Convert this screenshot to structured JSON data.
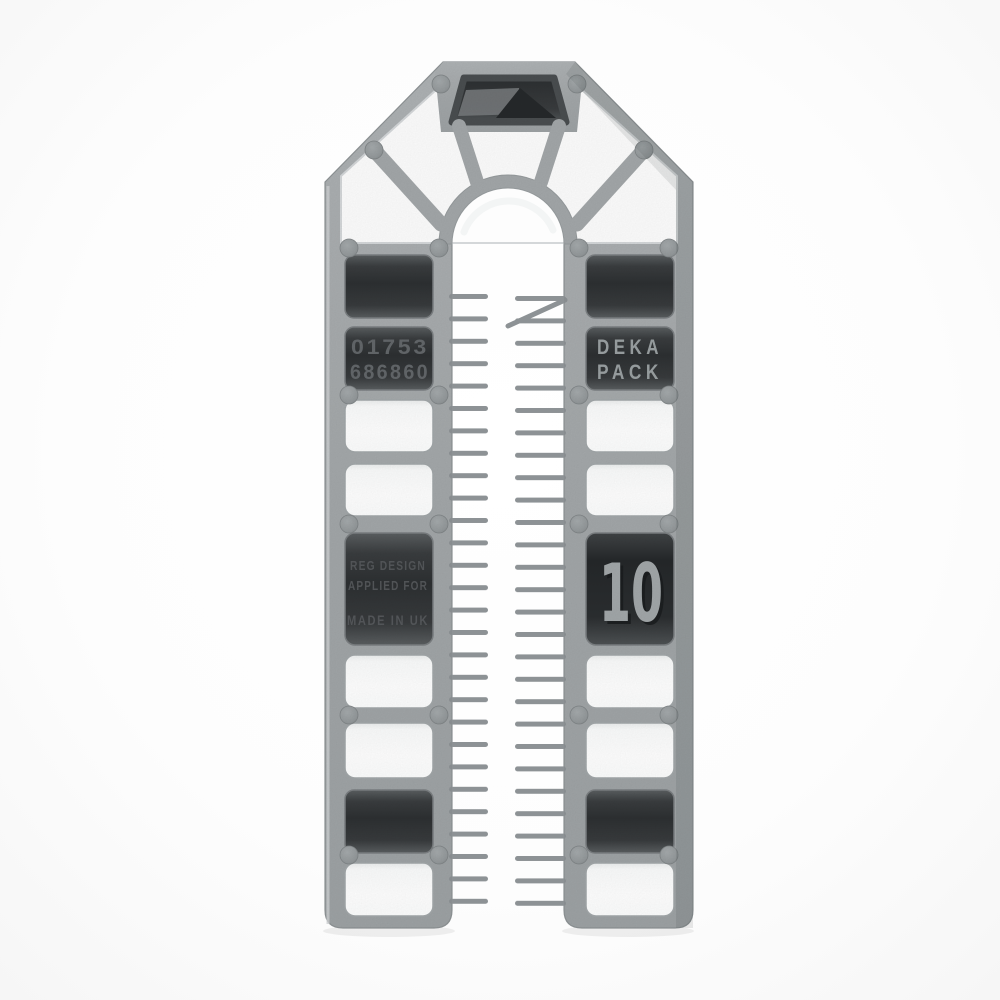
{
  "photo": {
    "subject": "Grey plastic horseshoe packer shim, front view on white background",
    "background_color": "#fdfdfd",
    "plastic_color": "#a4a8aa",
    "recess_color": "#2d3032",
    "tooth_color": "#8d9295"
  },
  "markings": {
    "phone_line1": "01753",
    "phone_line2": "686860",
    "brand_line1": "DEKA",
    "brand_line2": "PACK",
    "reg_line1": "REG DESIGN",
    "reg_line2": "APPLIED FOR",
    "made_in": "MADE IN UK",
    "size_label": "10"
  },
  "structure": {
    "teeth_per_side": 28,
    "left_leg_cells": [
      "recess",
      "recess-text",
      "hole",
      "hole",
      "recess-text",
      "hole",
      "hole",
      "recess",
      "hole"
    ],
    "right_leg_cells": [
      "recess",
      "recess-text",
      "hole",
      "hole",
      "recess-size",
      "hole",
      "hole",
      "recess",
      "hole"
    ]
  }
}
